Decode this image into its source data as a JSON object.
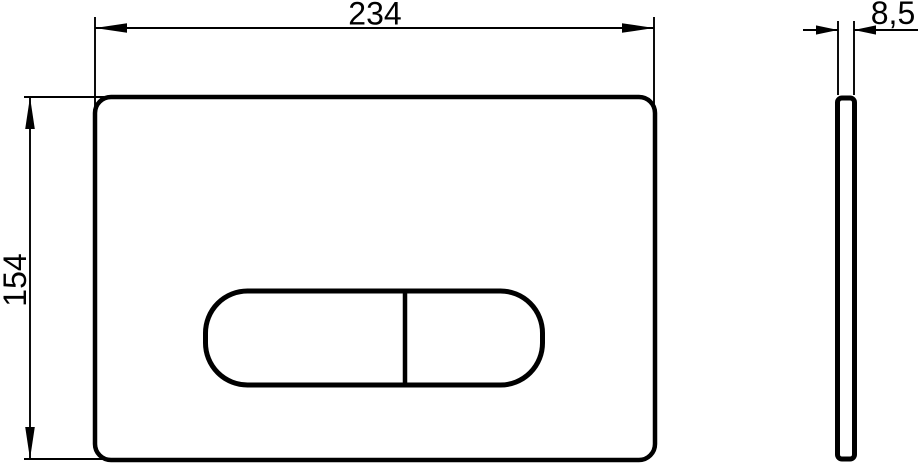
{
  "drawing": {
    "type": "technical-dimension-drawing",
    "subject": "flush-plate with dual-flush pill button, front view and side view",
    "dimensions": {
      "width": "234",
      "height": "154",
      "thickness": "8,5"
    },
    "colors": {
      "line": "#000000",
      "background": "#ffffff"
    }
  }
}
